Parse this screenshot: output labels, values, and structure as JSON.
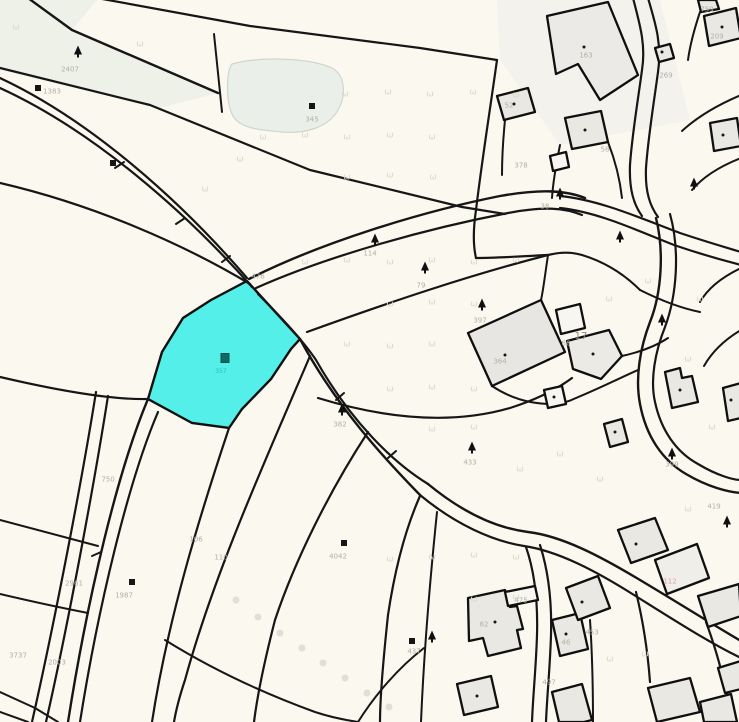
{
  "map": {
    "type": "cadastral-parcel-map",
    "background_color": "#faf8ef",
    "boundary_color": "#161616",
    "building_fill": "#e9e8e3",
    "woodland_fill": "#edf1e8",
    "selected_parcel": {
      "label": "357",
      "fill": "#55efe9",
      "outline": "#101010"
    },
    "labels": [
      {
        "text": "476",
        "x": 258,
        "y": 277
      },
      {
        "text": "2407",
        "x": 70,
        "y": 70
      },
      {
        "text": "1383",
        "x": 52,
        "y": 92
      },
      {
        "text": "345",
        "x": 312,
        "y": 120
      },
      {
        "text": "114",
        "x": 370,
        "y": 254
      },
      {
        "text": "79",
        "x": 421,
        "y": 286
      },
      {
        "text": "397",
        "x": 480,
        "y": 321
      },
      {
        "text": "382",
        "x": 340,
        "y": 425
      },
      {
        "text": "433",
        "x": 470,
        "y": 463
      },
      {
        "text": "357",
        "x": 221,
        "y": 372,
        "cls": "teal"
      },
      {
        "text": "750",
        "x": 108,
        "y": 480
      },
      {
        "text": "2961",
        "x": 74,
        "y": 584
      },
      {
        "text": "2003",
        "x": 57,
        "y": 663
      },
      {
        "text": "1987",
        "x": 124,
        "y": 596
      },
      {
        "text": "4042",
        "x": 338,
        "y": 557
      },
      {
        "text": "106",
        "x": 196,
        "y": 540
      },
      {
        "text": "110",
        "x": 221,
        "y": 558
      },
      {
        "text": "3737",
        "x": 18,
        "y": 656
      },
      {
        "text": "17",
        "x": 581,
        "y": 337,
        "cls": "dark"
      },
      {
        "text": "112",
        "x": 670,
        "y": 582,
        "cls": "red"
      },
      {
        "text": "475",
        "x": 521,
        "y": 601
      },
      {
        "text": "453",
        "x": 592,
        "y": 633
      },
      {
        "text": "497",
        "x": 549,
        "y": 683
      },
      {
        "text": "209",
        "x": 717,
        "y": 37
      },
      {
        "text": "759",
        "x": 707,
        "y": 10
      },
      {
        "text": "269",
        "x": 666,
        "y": 76
      },
      {
        "text": "58",
        "x": 605,
        "y": 150
      },
      {
        "text": "38",
        "x": 545,
        "y": 207
      },
      {
        "text": "378",
        "x": 521,
        "y": 166
      },
      {
        "text": "52",
        "x": 509,
        "y": 106
      },
      {
        "text": "163",
        "x": 586,
        "y": 56
      },
      {
        "text": "364",
        "x": 500,
        "y": 362
      },
      {
        "text": "66",
        "x": 566,
        "y": 344
      },
      {
        "text": "419",
        "x": 714,
        "y": 507
      },
      {
        "text": "46",
        "x": 566,
        "y": 643
      },
      {
        "text": "82",
        "x": 484,
        "y": 625
      },
      {
        "text": "437",
        "x": 414,
        "y": 652
      },
      {
        "text": "399",
        "x": 672,
        "y": 465
      }
    ],
    "symbols": [
      {
        "t": "tree",
        "x": 78,
        "y": 50
      },
      {
        "t": "tree",
        "x": 375,
        "y": 238
      },
      {
        "t": "tree",
        "x": 425,
        "y": 266
      },
      {
        "t": "tree",
        "x": 482,
        "y": 303
      },
      {
        "t": "tree",
        "x": 342,
        "y": 408
      },
      {
        "t": "tree",
        "x": 472,
        "y": 446
      },
      {
        "t": "tree",
        "x": 560,
        "y": 192
      },
      {
        "t": "tree",
        "x": 620,
        "y": 235
      },
      {
        "t": "tree",
        "x": 432,
        "y": 635
      },
      {
        "t": "tree",
        "x": 727,
        "y": 520
      },
      {
        "t": "tree",
        "x": 662,
        "y": 318
      },
      {
        "t": "tree",
        "x": 694,
        "y": 182
      },
      {
        "t": "tree",
        "x": 672,
        "y": 452
      },
      {
        "t": "sq",
        "x": 38,
        "y": 88
      },
      {
        "t": "sq",
        "x": 113,
        "y": 163
      },
      {
        "t": "sq",
        "x": 312,
        "y": 106
      },
      {
        "t": "sq",
        "x": 132,
        "y": 582
      },
      {
        "t": "sq",
        "x": 344,
        "y": 543
      },
      {
        "t": "sq",
        "x": 412,
        "y": 641
      },
      {
        "t": "tsq",
        "x": 225,
        "y": 358
      },
      {
        "t": "dot",
        "x": 722,
        "y": 27
      },
      {
        "t": "dot",
        "x": 514,
        "y": 104
      },
      {
        "t": "dot",
        "x": 585,
        "y": 130
      },
      {
        "t": "dot",
        "x": 505,
        "y": 355
      },
      {
        "t": "dot",
        "x": 593,
        "y": 354
      },
      {
        "t": "dot",
        "x": 495,
        "y": 622
      },
      {
        "t": "dot",
        "x": 566,
        "y": 634
      },
      {
        "t": "dot",
        "x": 477,
        "y": 696
      },
      {
        "t": "dot",
        "x": 582,
        "y": 602
      },
      {
        "t": "dot",
        "x": 636,
        "y": 544
      },
      {
        "t": "dot",
        "x": 723,
        "y": 135
      },
      {
        "t": "dot",
        "x": 731,
        "y": 400
      },
      {
        "t": "dot",
        "x": 554,
        "y": 397
      },
      {
        "t": "dot",
        "x": 615,
        "y": 432
      },
      {
        "t": "dot",
        "x": 662,
        "y": 52
      },
      {
        "t": "dot",
        "x": 584,
        "y": 47
      },
      {
        "t": "dot",
        "x": 680,
        "y": 390
      },
      {
        "t": "circle",
        "x": 236,
        "y": 600
      },
      {
        "t": "circle",
        "x": 258,
        "y": 617
      },
      {
        "t": "circle",
        "x": 280,
        "y": 633
      },
      {
        "t": "circle",
        "x": 302,
        "y": 648
      },
      {
        "t": "circle",
        "x": 323,
        "y": 663
      },
      {
        "t": "circle",
        "x": 345,
        "y": 678
      },
      {
        "t": "circle",
        "x": 367,
        "y": 693
      },
      {
        "t": "circle",
        "x": 389,
        "y": 707
      },
      {
        "t": "meadow",
        "x": 345,
        "y": 95
      },
      {
        "t": "meadow",
        "x": 388,
        "y": 93
      },
      {
        "t": "meadow",
        "x": 430,
        "y": 95
      },
      {
        "t": "meadow",
        "x": 473,
        "y": 93
      },
      {
        "t": "meadow",
        "x": 516,
        "y": 96
      },
      {
        "t": "meadow",
        "x": 263,
        "y": 138
      },
      {
        "t": "meadow",
        "x": 305,
        "y": 136
      },
      {
        "t": "meadow",
        "x": 347,
        "y": 138
      },
      {
        "t": "meadow",
        "x": 390,
        "y": 136
      },
      {
        "t": "meadow",
        "x": 432,
        "y": 138
      },
      {
        "t": "meadow",
        "x": 347,
        "y": 178
      },
      {
        "t": "meadow",
        "x": 390,
        "y": 176
      },
      {
        "t": "meadow",
        "x": 433,
        "y": 178
      },
      {
        "t": "meadow",
        "x": 305,
        "y": 263
      },
      {
        "t": "meadow",
        "x": 347,
        "y": 261
      },
      {
        "t": "meadow",
        "x": 390,
        "y": 263
      },
      {
        "t": "meadow",
        "x": 432,
        "y": 261
      },
      {
        "t": "meadow",
        "x": 474,
        "y": 263
      },
      {
        "t": "meadow",
        "x": 516,
        "y": 261
      },
      {
        "t": "meadow",
        "x": 390,
        "y": 305
      },
      {
        "t": "meadow",
        "x": 432,
        "y": 303
      },
      {
        "t": "meadow",
        "x": 474,
        "y": 305
      },
      {
        "t": "meadow",
        "x": 347,
        "y": 345
      },
      {
        "t": "meadow",
        "x": 390,
        "y": 347
      },
      {
        "t": "meadow",
        "x": 432,
        "y": 345
      },
      {
        "t": "meadow",
        "x": 390,
        "y": 390
      },
      {
        "t": "meadow",
        "x": 432,
        "y": 388
      },
      {
        "t": "meadow",
        "x": 474,
        "y": 390
      },
      {
        "t": "meadow",
        "x": 432,
        "y": 430
      },
      {
        "t": "meadow",
        "x": 474,
        "y": 428
      },
      {
        "t": "meadow",
        "x": 390,
        "y": 560
      },
      {
        "t": "meadow",
        "x": 432,
        "y": 558
      },
      {
        "t": "meadow",
        "x": 474,
        "y": 556
      },
      {
        "t": "meadow",
        "x": 516,
        "y": 558
      },
      {
        "t": "meadow",
        "x": 474,
        "y": 600
      },
      {
        "t": "meadow",
        "x": 516,
        "y": 598
      },
      {
        "t": "meadow",
        "x": 609,
        "y": 300
      },
      {
        "t": "meadow",
        "x": 648,
        "y": 282
      },
      {
        "t": "meadow",
        "x": 700,
        "y": 300
      },
      {
        "t": "meadow",
        "x": 688,
        "y": 360
      },
      {
        "t": "meadow",
        "x": 712,
        "y": 428
      },
      {
        "t": "meadow",
        "x": 645,
        "y": 655
      },
      {
        "t": "meadow",
        "x": 610,
        "y": 660
      },
      {
        "t": "meadow",
        "x": 688,
        "y": 510
      },
      {
        "t": "meadow",
        "x": 520,
        "y": 470
      },
      {
        "t": "meadow",
        "x": 560,
        "y": 455
      },
      {
        "t": "meadow",
        "x": 600,
        "y": 480
      },
      {
        "t": "meadow",
        "x": 16,
        "y": 28
      },
      {
        "t": "meadow",
        "x": 140,
        "y": 45
      },
      {
        "t": "meadow",
        "x": 205,
        "y": 190
      },
      {
        "t": "meadow",
        "x": 240,
        "y": 160
      }
    ]
  }
}
